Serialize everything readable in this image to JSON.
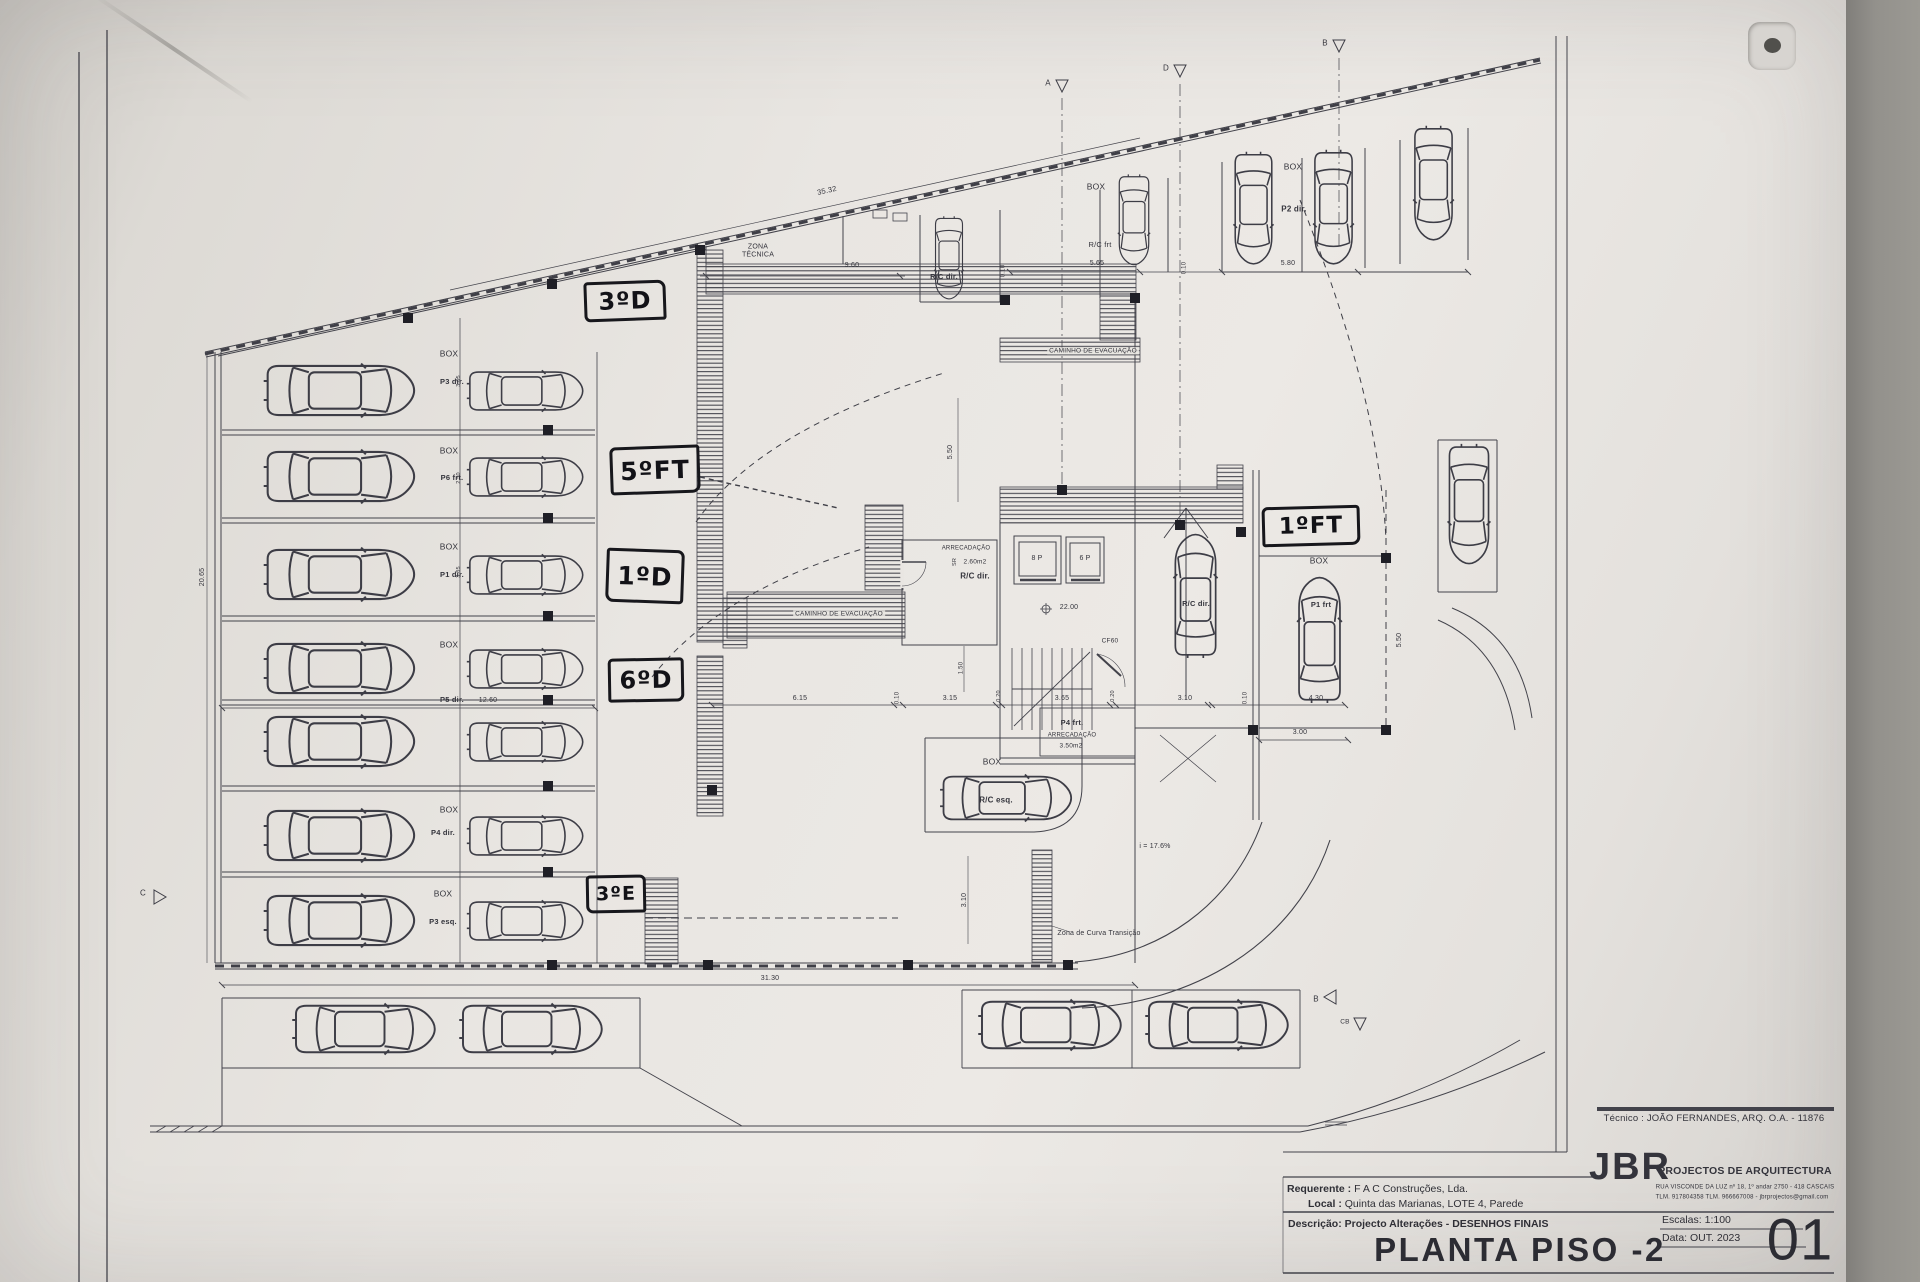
{
  "titleblock": {
    "tecnico": "Técnico : JOÃO FERNANDES, ARQ.   O.A. - 11876",
    "firm": "JBR",
    "firm_suffix": "PROJECTOS DE ARQUITECTURA",
    "firm_address1": "RUA VISCONDE DA LUZ nº 18, 1º andar   2750 - 418   CASCAIS",
    "firm_address2": "TLM. 917804358  TLM. 966667008  -  jbrprojectos@gmail.com",
    "requerente_label": "Requerente :",
    "requerente_value": "F A C  Construções, Lda.",
    "local_label": "Local :",
    "local_value": "Quinta das Marianas, LOTE 4, Parede",
    "descricao_label": "Descrição:",
    "descricao_value": "Projecto Alterações - DESENHOS FINAIS",
    "sheet_title": "PLANTA PISO -2",
    "escala": "Escalas:  1:100",
    "data": "Data: OUT.  2023",
    "sheet_number": "01"
  },
  "handwritten": {
    "h1": "3ºD",
    "h2": "5ºFT",
    "h3": "1ºD",
    "h4": "6ºD",
    "h5": "3ºE",
    "h6": "1ºFT"
  },
  "labels": {
    "zona_tecnica": "ZONA\nTÉCNICA",
    "caminho": "CAMINHO  DE  EVACUAÇÃO",
    "box": "BOX",
    "p3dir": "P3 dir.",
    "p6frt": "P6 frt.",
    "p1dir": "P1 dir.",
    "p5dir": "P5 dir.",
    "p4dir": "P4 dir.",
    "p3esq": "P3 esq.",
    "p2dir": "P2 dir.",
    "p1frt": "P1 frt",
    "p4frt": "P4 frt.",
    "rc_dir": "R/C dir.",
    "rc_frt": "R/C frt",
    "rc_esq": "R/C esq.",
    "arrecadacao": "ARRECADAÇÃO",
    "area_260": "2.60m2",
    "area_350": "3.50m2",
    "sr": "SR",
    "elev8": "8 P",
    "elev6": "6 P",
    "nivel": "22.00",
    "cf60": "CF60",
    "slope": "i = 17.6%",
    "curva": "Zona de Curva Transição"
  },
  "dimensions": {
    "d35_32": "35.32",
    "d9_60": "9.60",
    "d5_65": "5.65",
    "d5_80": "5.80",
    "d0_10": "0.10",
    "d6_15": "6.15",
    "d3_15": "3.15",
    "d0_20": "0.20",
    "d3_65": "3.65",
    "d3_10": "3.10",
    "d4_30": "4.30",
    "d12_60": "12.60",
    "d31_30": "31.30",
    "d3_00": "3.00",
    "d5_50": "5.50",
    "d1_50": "1.50",
    "d20_65": "20.65",
    "d3_05": "3.05",
    "d2_50": "2.50"
  },
  "markers": {
    "a": "A",
    "b": "B",
    "c": "C",
    "d": "D",
    "cb": "CB"
  }
}
